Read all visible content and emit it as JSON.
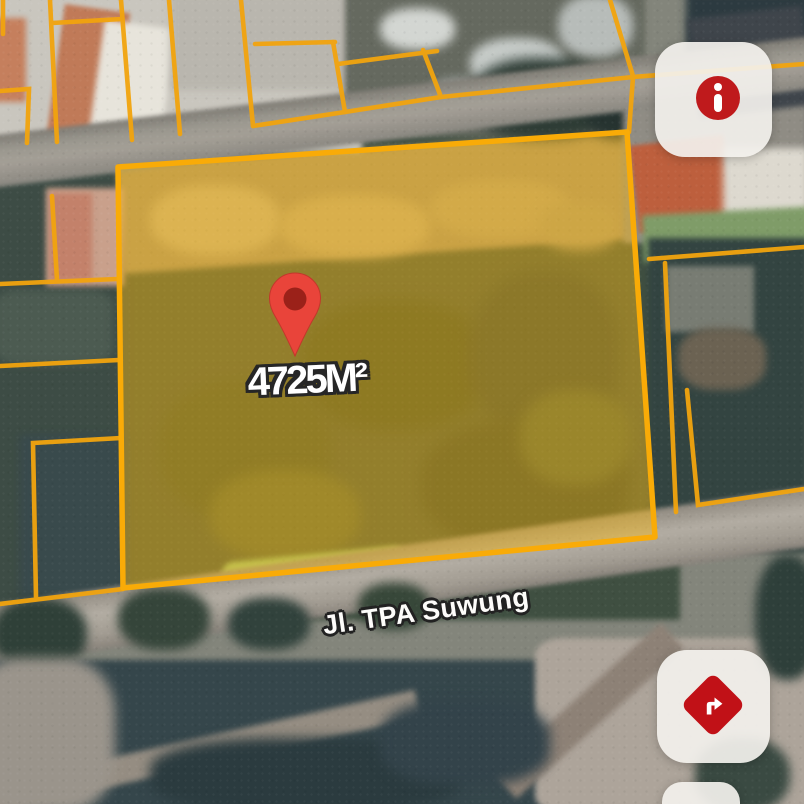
{
  "map": {
    "marker_area_label": "4725M²",
    "street_name": "Jl. TPA Suwung"
  },
  "icons": {
    "pin": "map-pin-icon",
    "info": "info-icon",
    "directions": "turn-right-icon"
  },
  "colors": {
    "parcel_outline": "#f6a70b",
    "parcel_fill_tint": "#fabe19",
    "pin_red": "#e9443a",
    "pin_inner": "#8f1d14",
    "control_red": "#c1121a",
    "label_text": "#ffffff"
  }
}
